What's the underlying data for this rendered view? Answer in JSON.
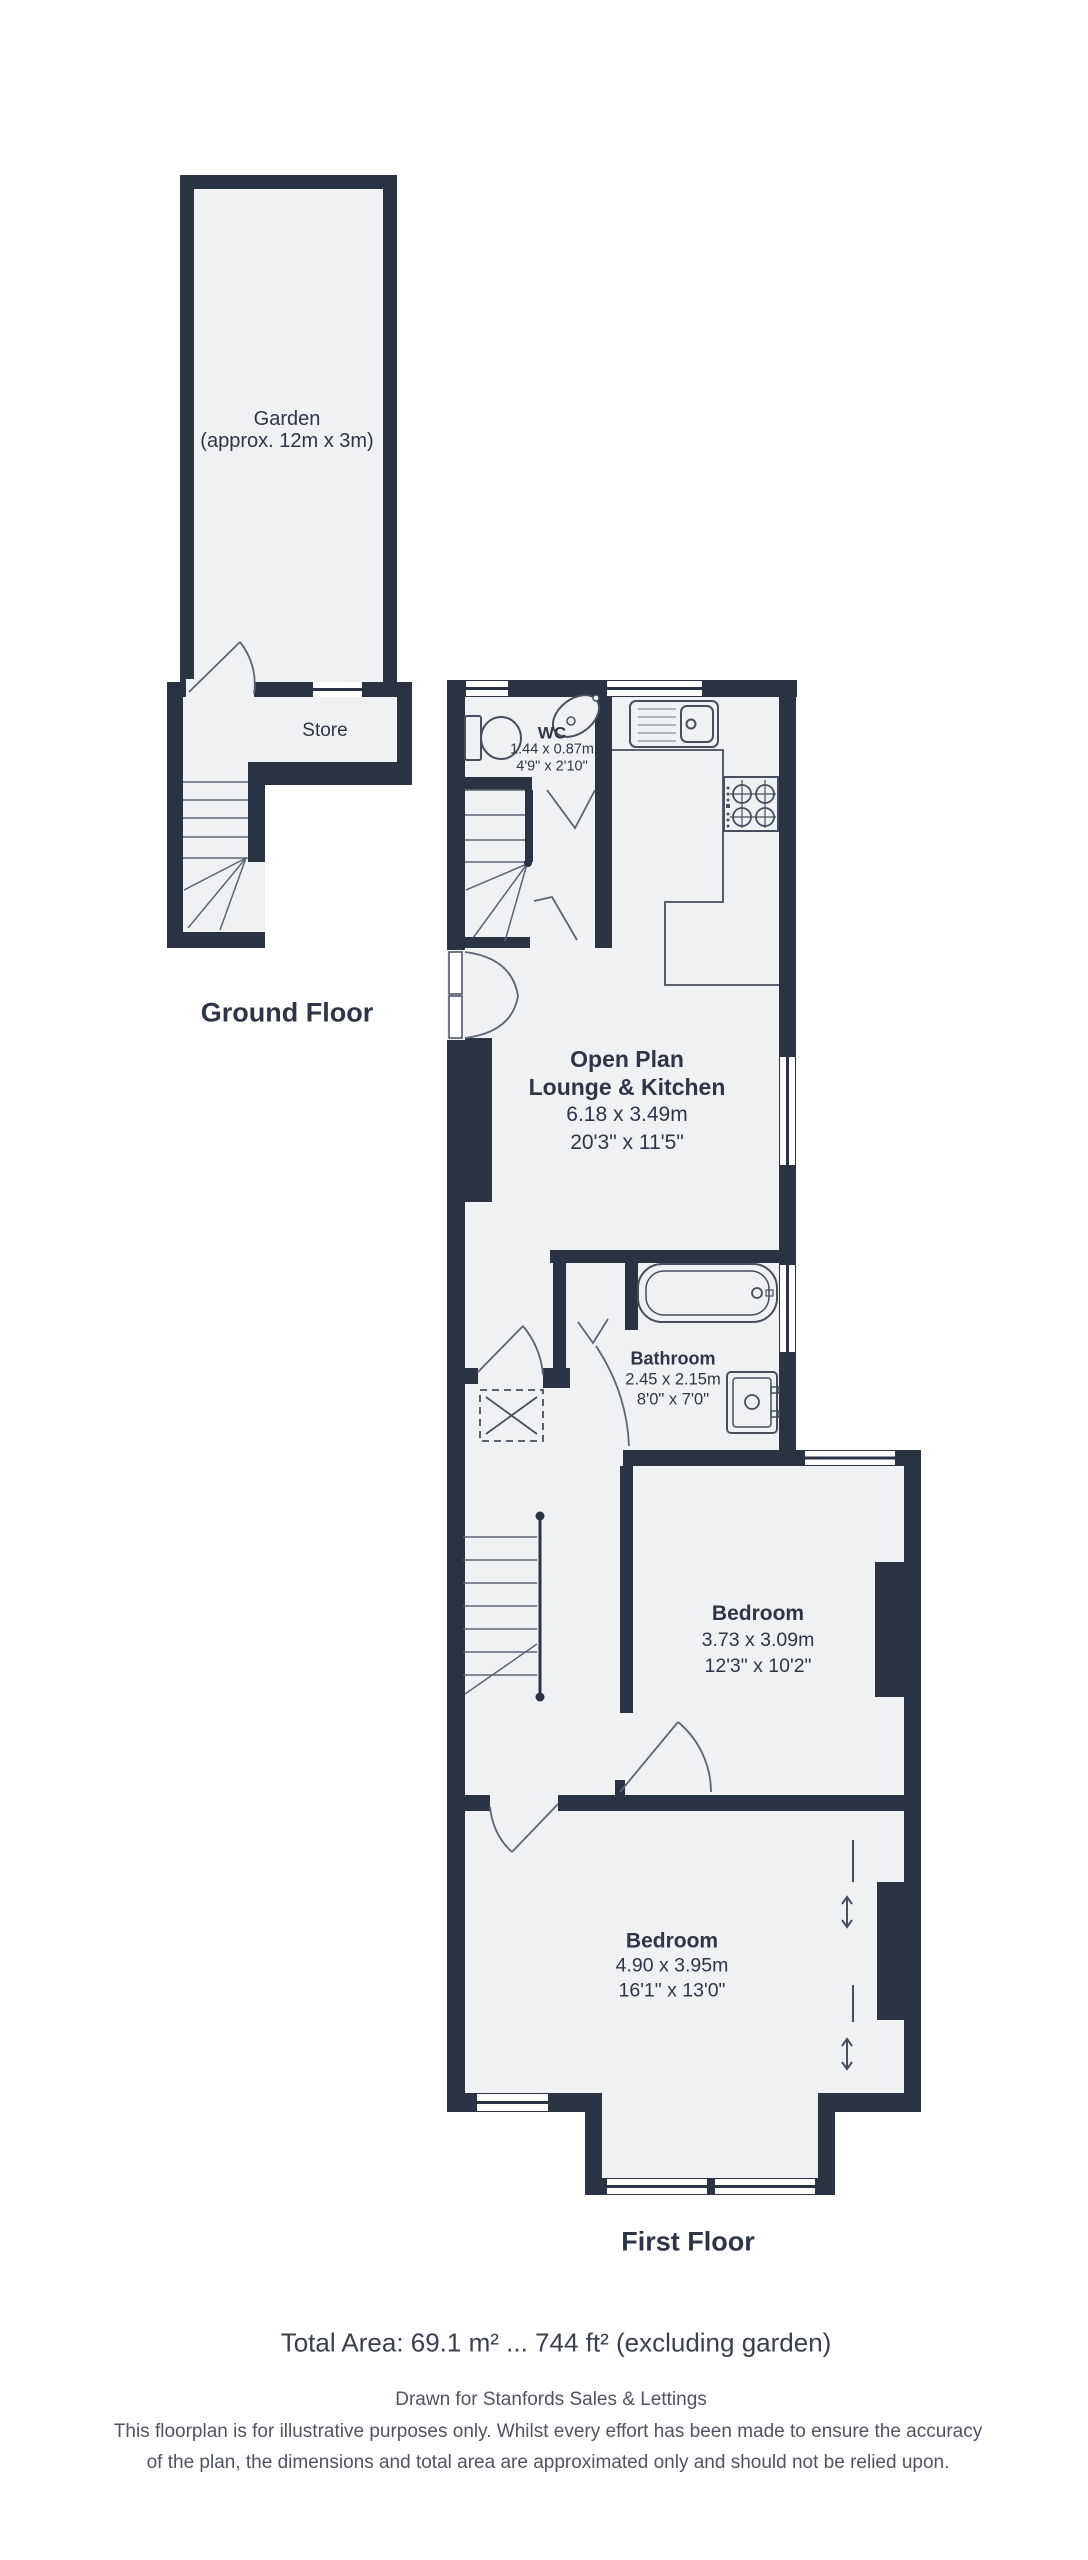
{
  "ground_floor": {
    "label": "Ground Floor",
    "rooms": {
      "garden": {
        "name": "Garden",
        "dims": "(approx. 12m x 3m)"
      },
      "store": {
        "name": "Store"
      }
    }
  },
  "first_floor": {
    "label": "First Floor",
    "rooms": {
      "wc": {
        "name": "WC",
        "metric": "1.44 x 0.87m",
        "imperial": "4'9\" x 2'10\""
      },
      "lounge": {
        "name_line1": "Open Plan",
        "name_line2": "Lounge & Kitchen",
        "metric": "6.18 x 3.49m",
        "imperial": "20'3\" x 11'5\""
      },
      "bathroom": {
        "name": "Bathroom",
        "metric": "2.45 x 2.15m",
        "imperial": "8'0\" x 7'0\""
      },
      "bedroom_rear": {
        "name": "Bedroom",
        "metric": "3.73 x 3.09m",
        "imperial": "12'3\" x 10'2\""
      },
      "bedroom_front": {
        "name": "Bedroom",
        "metric": "4.90 x 3.95m",
        "imperial": "16'1\" x 13'0\""
      }
    }
  },
  "footer": {
    "total_area": "Total Area: 69.1 m² ... 744 ft² (excluding garden)",
    "drawn_for": "Drawn for Stanfords Sales & Lettings",
    "disclaimer_line1": "This floorplan is for illustrative purposes only. Whilst every effort has been made to ensure the accuracy",
    "disclaimer_line2": "of the plan, the dimensions and total area are approximated only and should not be relied upon."
  },
  "colors": {
    "wall": "#2b3242",
    "floor": "#f0f1f3",
    "ink": "#2e3547",
    "muted": "#4f545f",
    "fixture": "#474e5c",
    "lightline": "#97a0ac",
    "stepline": "#5d6574"
  }
}
